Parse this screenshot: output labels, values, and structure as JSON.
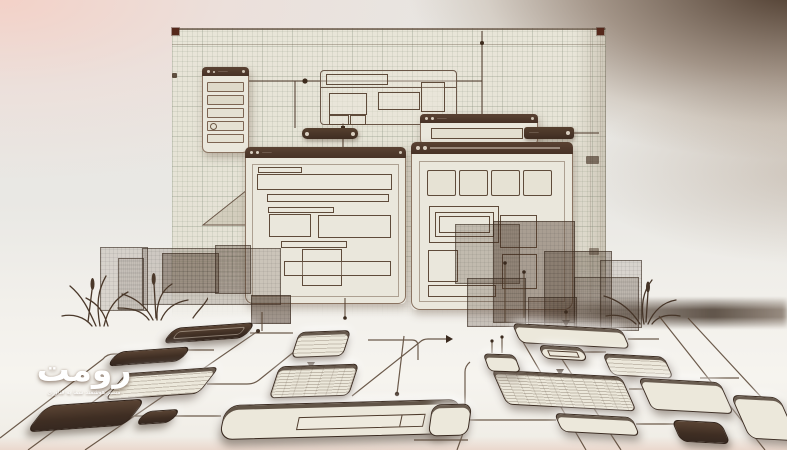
{
  "brand": {
    "name": "رومت",
    "tagline": "مسیر هوشمند شما به فناوری"
  },
  "titlebars": {
    "sidebar_window": "⸻",
    "mini_browser": "⸻",
    "collapsed_bar": "⸻",
    "left_window": "⸻",
    "right_window": "⸻⸻⸻"
  },
  "colors": {
    "chrome": "#4c362a",
    "paper": "#e7e4d7",
    "ink": "#54402f",
    "background_pink": "#f3d6cc",
    "background_brown": "#54402f",
    "logo_text": "#ffffff",
    "corner_marker": "#55281b"
  }
}
